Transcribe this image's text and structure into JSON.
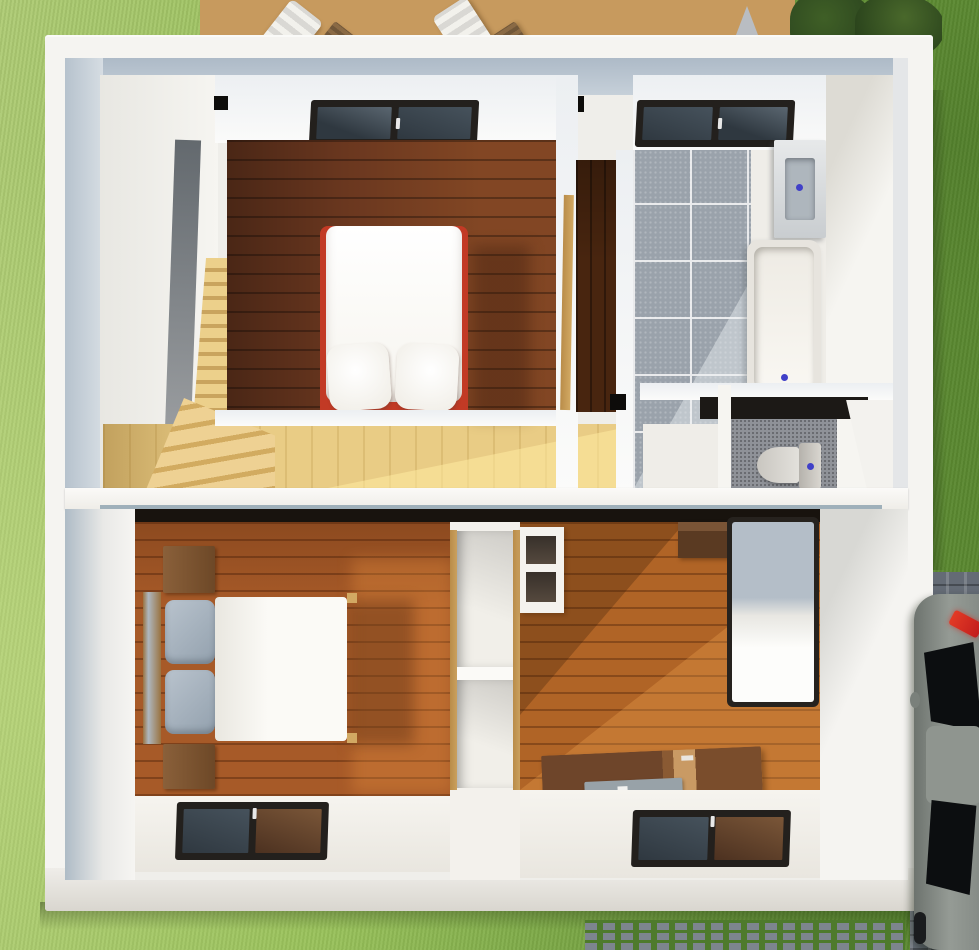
{
  "scene": {
    "description": "Top-down 3D architectural render of a house interior (two stacked floor sections) surrounded by lawn, wooden deck with furniture at top, cobblestone driveway with parked car at right",
    "exterior": {
      "lawn": {
        "color_light": "#aecb74",
        "color_dark": "#659636"
      },
      "deck": {
        "material": "wood planks",
        "color": "#c79a5e",
        "furniture": [
          "lounge-chair",
          "wooden-chair",
          "round-table",
          "lounge-chair",
          "wooden-chair"
        ],
        "table_color": "#d2821f"
      },
      "bushes": {
        "color": "#273f1d"
      },
      "roof_gable": {
        "color": "#b9bdc2"
      },
      "driveway": {
        "paving": "cobblestone",
        "color": "#6f7681"
      },
      "car": {
        "body_color": "#868c86",
        "glass_color": "#0c0e10",
        "taillight_color": "#c21d1d"
      },
      "grass_pavers": {
        "block_color": "#7d858e",
        "joint_color": "#4e7a2c"
      }
    },
    "upper_section": {
      "rooms": [
        {
          "name": "stairwell",
          "feature": "staircase descending to lower level",
          "step_color": "#ecd08b"
        },
        {
          "name": "landing",
          "floor": "light oak",
          "floor_color": "#e9cc85"
        },
        {
          "name": "master-bedroom",
          "floor": "dark walnut planks",
          "floor_color": "#6a371f",
          "furniture": [
            {
              "name": "double-bed",
              "frame_color": "#c23a25",
              "mattress_color": "#fbfaf6",
              "pillows": 2
            }
          ],
          "skylight": true
        },
        {
          "name": "walk-in-closet",
          "door_color": "#d2a963",
          "floor_color": "#48250f"
        },
        {
          "name": "bathroom",
          "floor": "grey tiles",
          "tile_color": "#9aa2ab",
          "fixtures": [
            "sink",
            "bathtub"
          ],
          "skylight": true
        },
        {
          "name": "wc",
          "floor_color": "#8f9298",
          "fixtures": [
            "toilet"
          ]
        }
      ]
    },
    "lower_section": {
      "rooms": [
        {
          "name": "bedroom-left",
          "floor_color": "#a75a28",
          "furniture": [
            {
              "name": "double-bed",
              "duvet_color": "#f4f2ec",
              "pillow_color": "#a7b3bf"
            },
            {
              "name": "nightstand",
              "color": "#7d5634"
            },
            {
              "name": "nightstand",
              "color": "#7d5634"
            }
          ],
          "skylight": true
        },
        {
          "name": "wardrobe-column",
          "trim_color": "#caa05e",
          "shelf_color": "#f1efe9"
        },
        {
          "name": "bedroom-right",
          "floor_color": "#b06426",
          "furniture": [
            {
              "name": "single-bed",
              "frame_color": "#26221e"
            },
            {
              "name": "desk",
              "color": "#6e452a",
              "accent": "#c99a64"
            },
            {
              "name": "laptop-tray",
              "color": "#98a2a8"
            },
            {
              "name": "shelf-unit"
            },
            {
              "name": "wall-shelf",
              "color": "#5a3a22"
            }
          ],
          "skylight": true
        }
      ]
    }
  },
  "palette": {
    "lawn1": "#aecb74",
    "lawn2": "#8fbb51",
    "lawn3": "#79a943",
    "lawn4": "#659636",
    "deck": "#c79a5e",
    "table": "#d2821f",
    "wall": "#f5f4f1",
    "wallDim": "#e8e7e2",
    "ceil1": "#adbac7",
    "ceil2": "#c6d0d9",
    "stairStep1": "#ecd08b",
    "stairStep2": "#c9a45e",
    "landing1": "#e9cc85",
    "floorDark": "#6a371f",
    "floorOrange": "#a75a28",
    "floorOrange2": "#b06426",
    "tile": "#9aa2ab",
    "tileLine": "#e9eaec",
    "wcFloor": "#8f9298",
    "closetFloor": "#48250f",
    "bedRed": "#c23a25",
    "duvet": "#f4f2ec",
    "pillowGray": "#a7b3bf",
    "tan": "#d2a963",
    "closetTan": "#caa05e",
    "frame": "#23201d",
    "pane1": "#46525c",
    "pane2": "#2f3840",
    "fixture": "#efede8",
    "basin": "#aeb6bd",
    "blue": "#4040c8",
    "wood1": "#7d5634",
    "desk1": "#6e452a",
    "desk2": "#c99a64",
    "tray": "#98a2a8",
    "cobble1": "#646b75",
    "paver": "#7d858e",
    "paverGreen": "#4e7a2c",
    "car1": "#7e847f",
    "car2": "#959b95",
    "carGlass": "#0c0e10",
    "tail": "#c21d1d"
  }
}
